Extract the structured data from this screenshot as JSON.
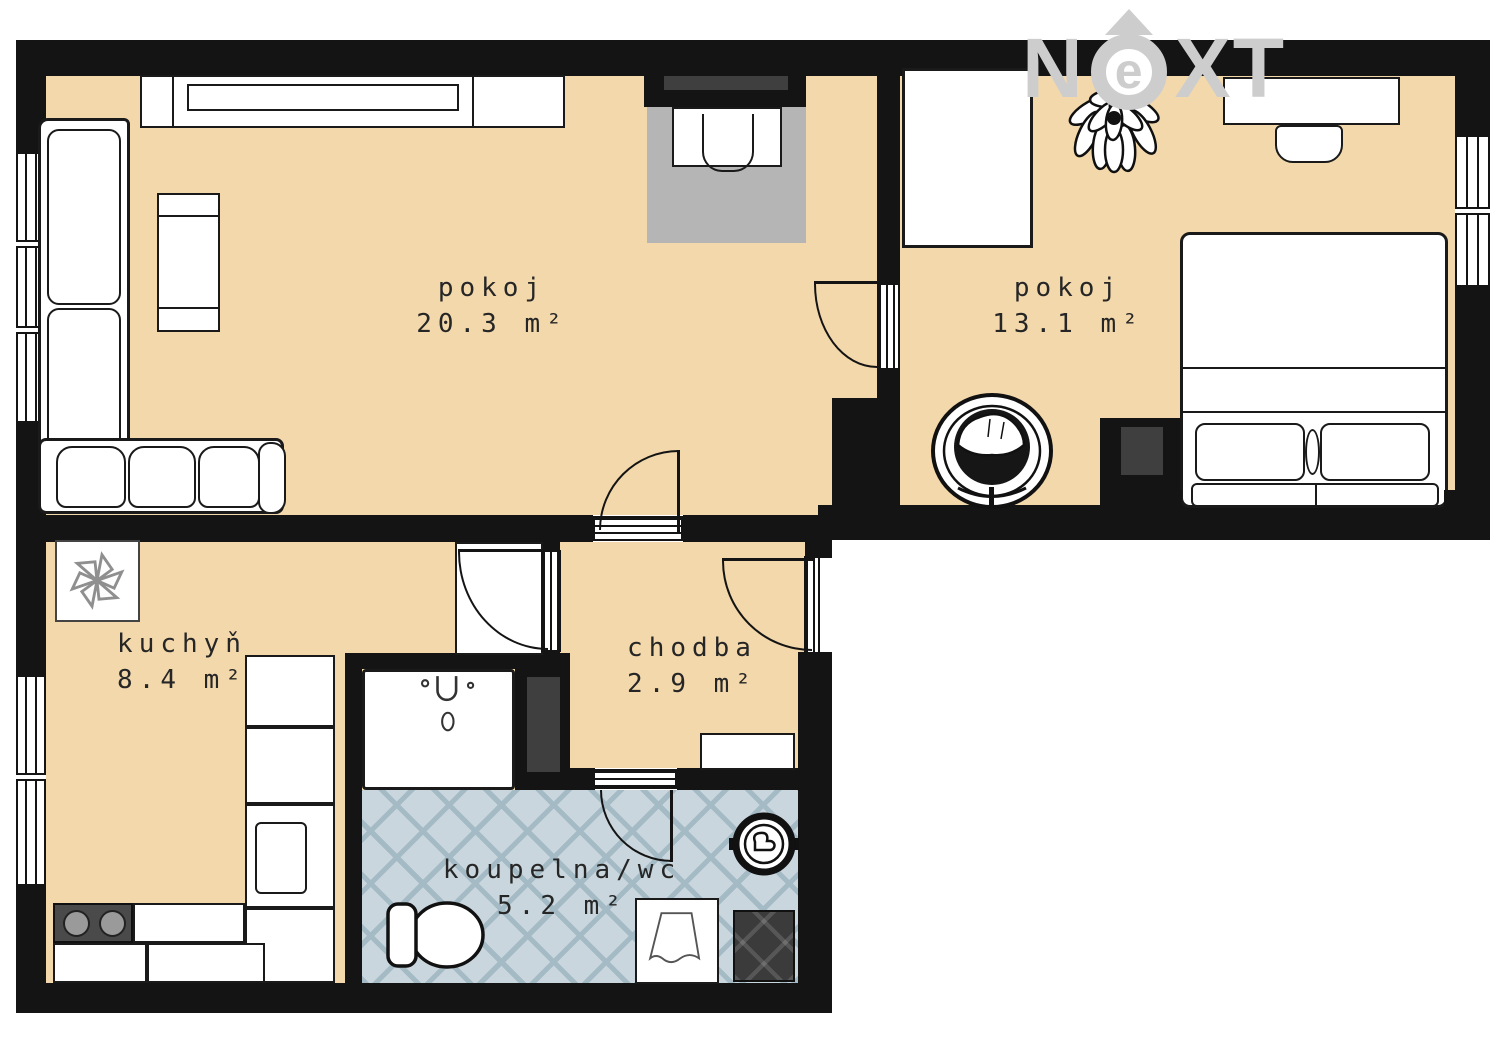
{
  "watermark": {
    "letters": [
      "N",
      "e",
      "X",
      "T"
    ],
    "color": "#cdcdcd"
  },
  "rooms": [
    {
      "id": "living-room",
      "name": "pokoj",
      "area": "20.3 m²"
    },
    {
      "id": "bedroom",
      "name": "pokoj",
      "area": "13.1 m²"
    },
    {
      "id": "kitchen",
      "name": "kuchyň",
      "area": "8.4 m²"
    },
    {
      "id": "hallway",
      "name": "chodba",
      "area": "2.9 m²"
    },
    {
      "id": "bathroom",
      "name": "koupelna/wc",
      "area": "5.2 m²"
    }
  ],
  "colors": {
    "floor": "#f3d8ab",
    "bath_tile": "#c9d6dd",
    "bath_tile_line": "#a4bac5",
    "wall": "#141414",
    "carpet": "#b5b5b5",
    "dark_inset": "#3f3f3f",
    "logo": "#cdcdcd",
    "furniture": "#ffffff"
  }
}
